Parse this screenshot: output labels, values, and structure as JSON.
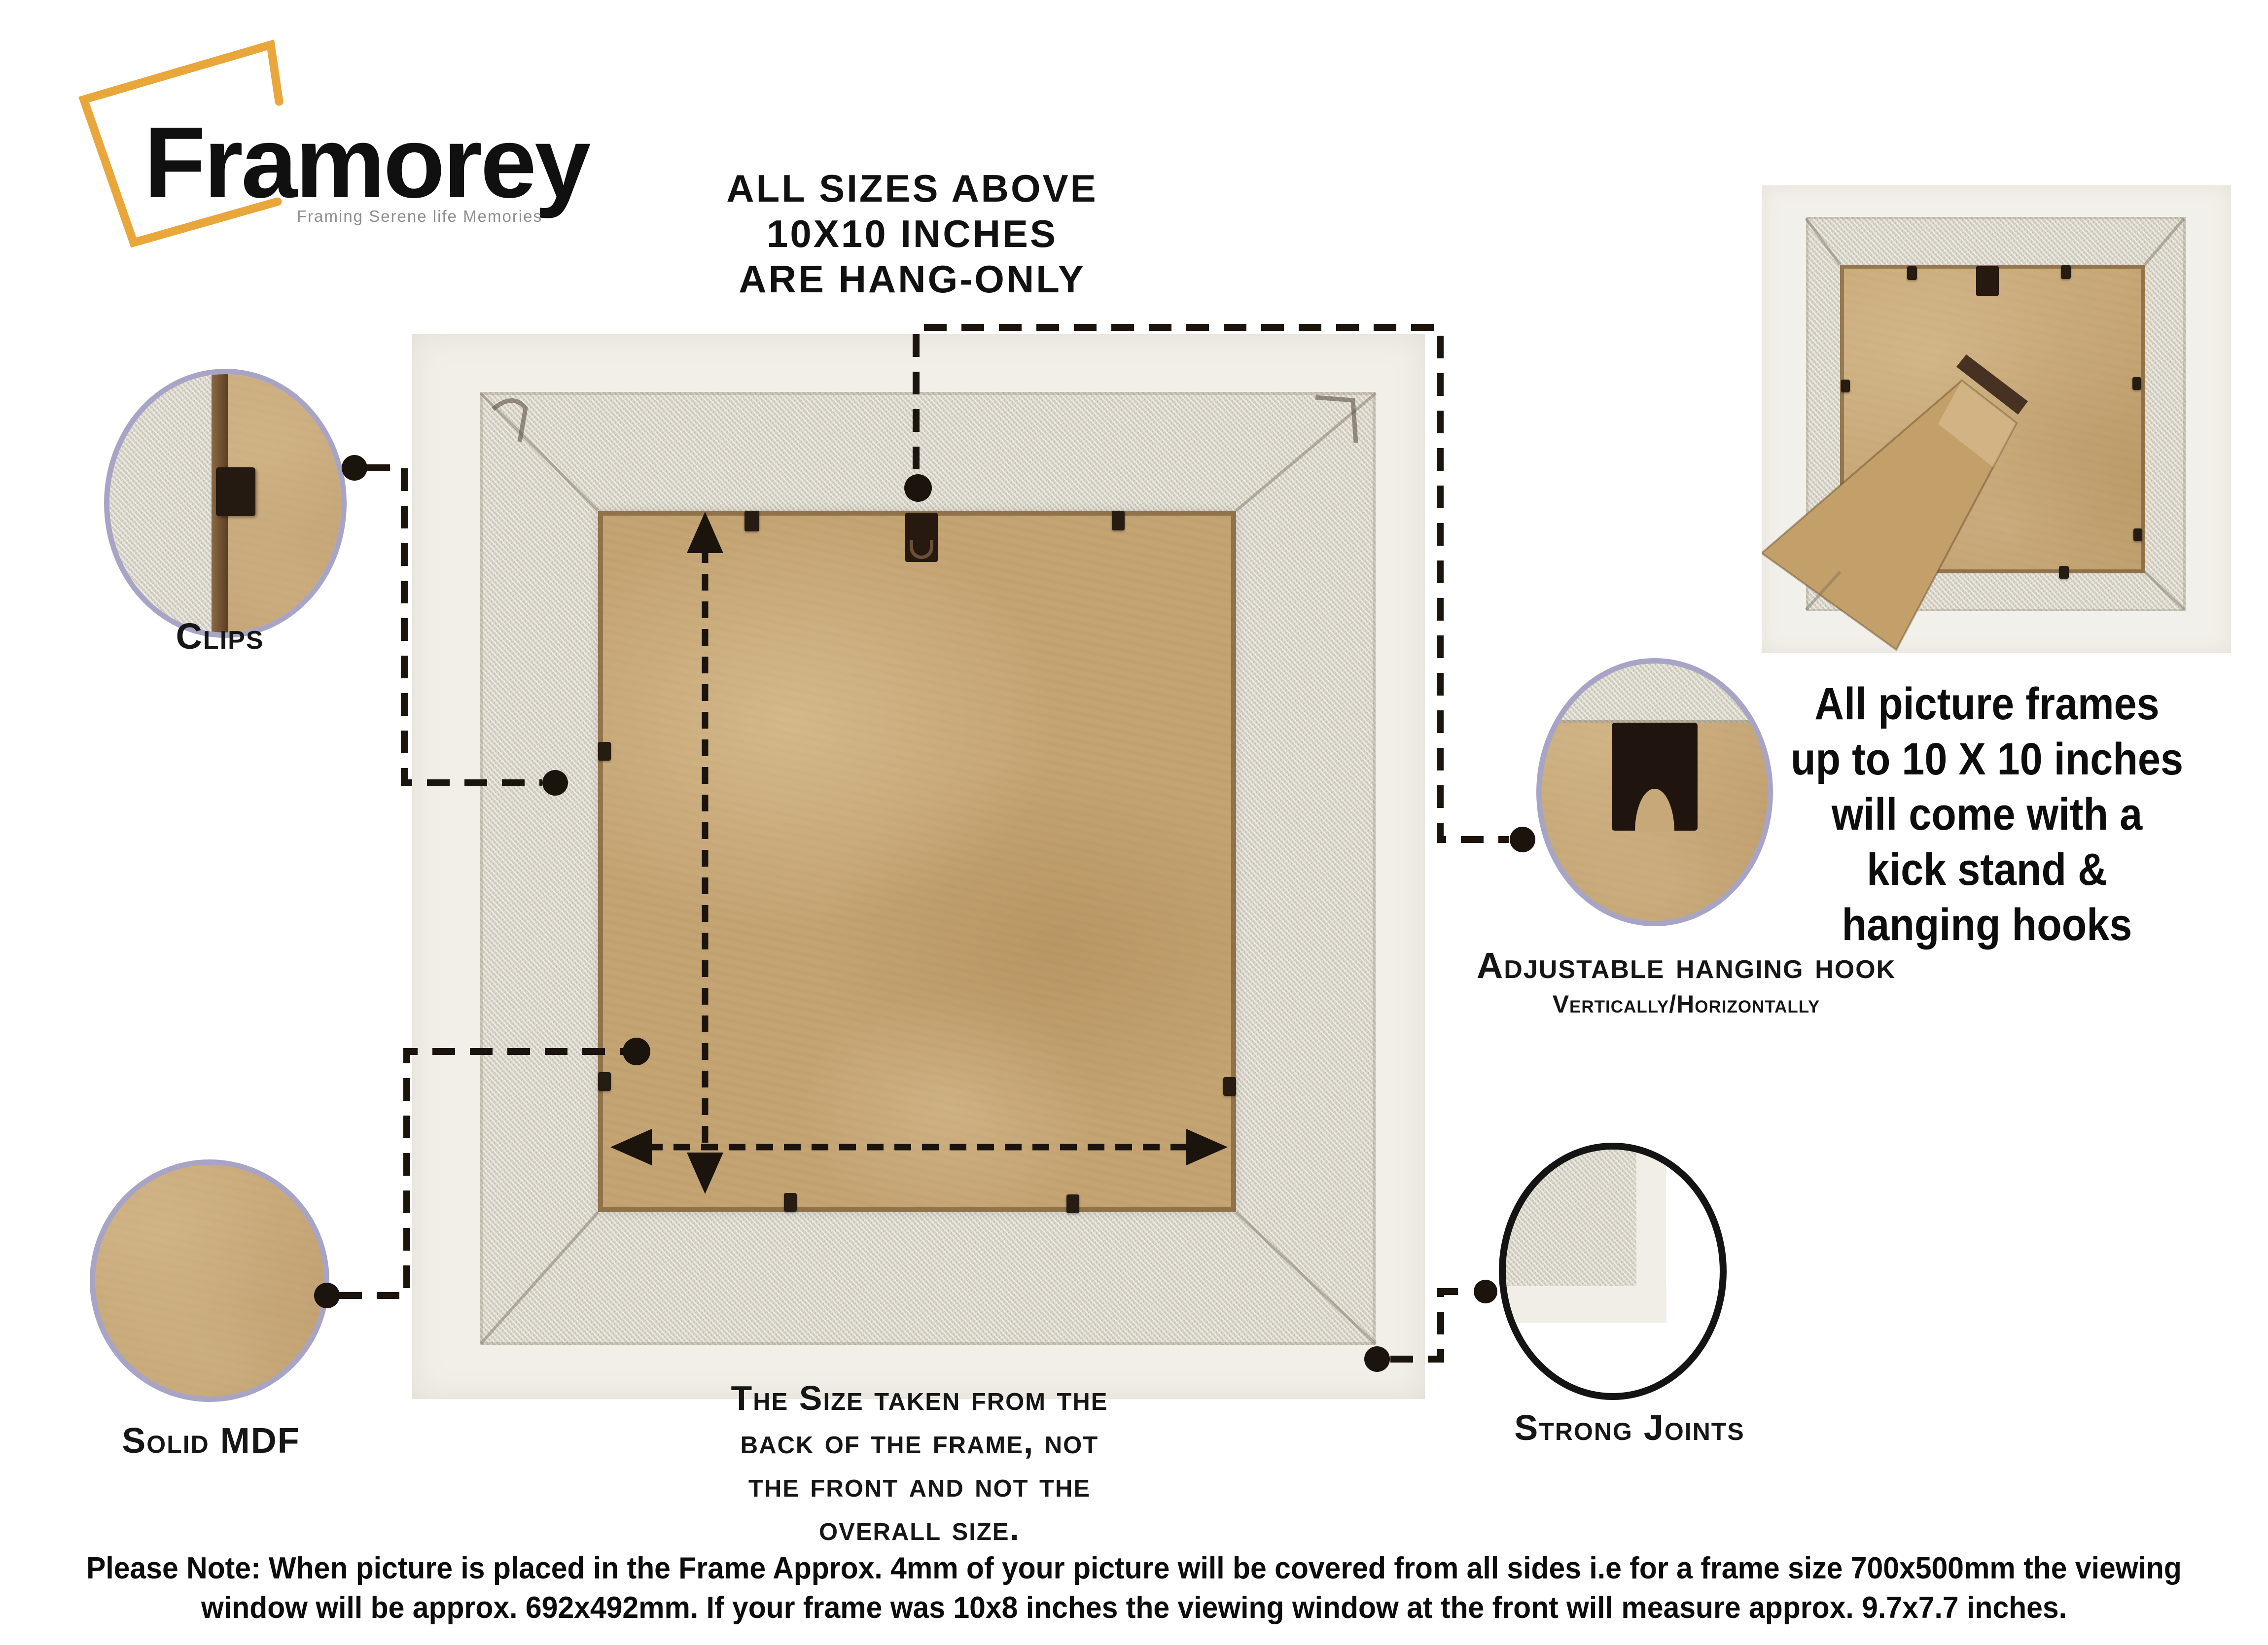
{
  "logo": {
    "name": "Framorey",
    "tagline": "Framing Serene life Memories"
  },
  "hang_note": {
    "lines": [
      "ALL SIZES ABOVE",
      "10X10 INCHES",
      "ARE HANG-ONLY"
    ]
  },
  "kickstand_note": {
    "lines": [
      "All picture frames",
      "up to 10 X 10 inches",
      "will come with a",
      "kick stand &",
      "hanging hooks"
    ]
  },
  "callouts": {
    "clips": {
      "label": "Clips"
    },
    "solid_mdf": {
      "label": "Solid MDF"
    },
    "strong_joints": {
      "label": "Strong Joints"
    },
    "hanging_hook": {
      "label": "Adjustable hanging hook",
      "sublabel": "Vertically/Horizontally"
    }
  },
  "size_note": {
    "lines": [
      "The Size taken from the",
      "back of the frame, not",
      "the front and not the",
      "overall size."
    ]
  },
  "footer_note": {
    "lines": [
      "Please Note: When picture is placed in the Frame Approx. 4mm of your picture will be covered from all sides i.e for a frame size 700x500mm the viewing",
      "window will be approx. 692x492mm. If your frame was 10x8 inches the viewing window at the front will measure approx. 9.7x7.7 inches."
    ]
  },
  "colors": {
    "accent_yellow": "#E9A63B",
    "circle_border": "#A8A4C5",
    "mdf_tan": "#C4A473",
    "moulding_grey": "#DBD7CA",
    "frame_white": "#F1EFE8",
    "line_black": "#1B140D"
  }
}
